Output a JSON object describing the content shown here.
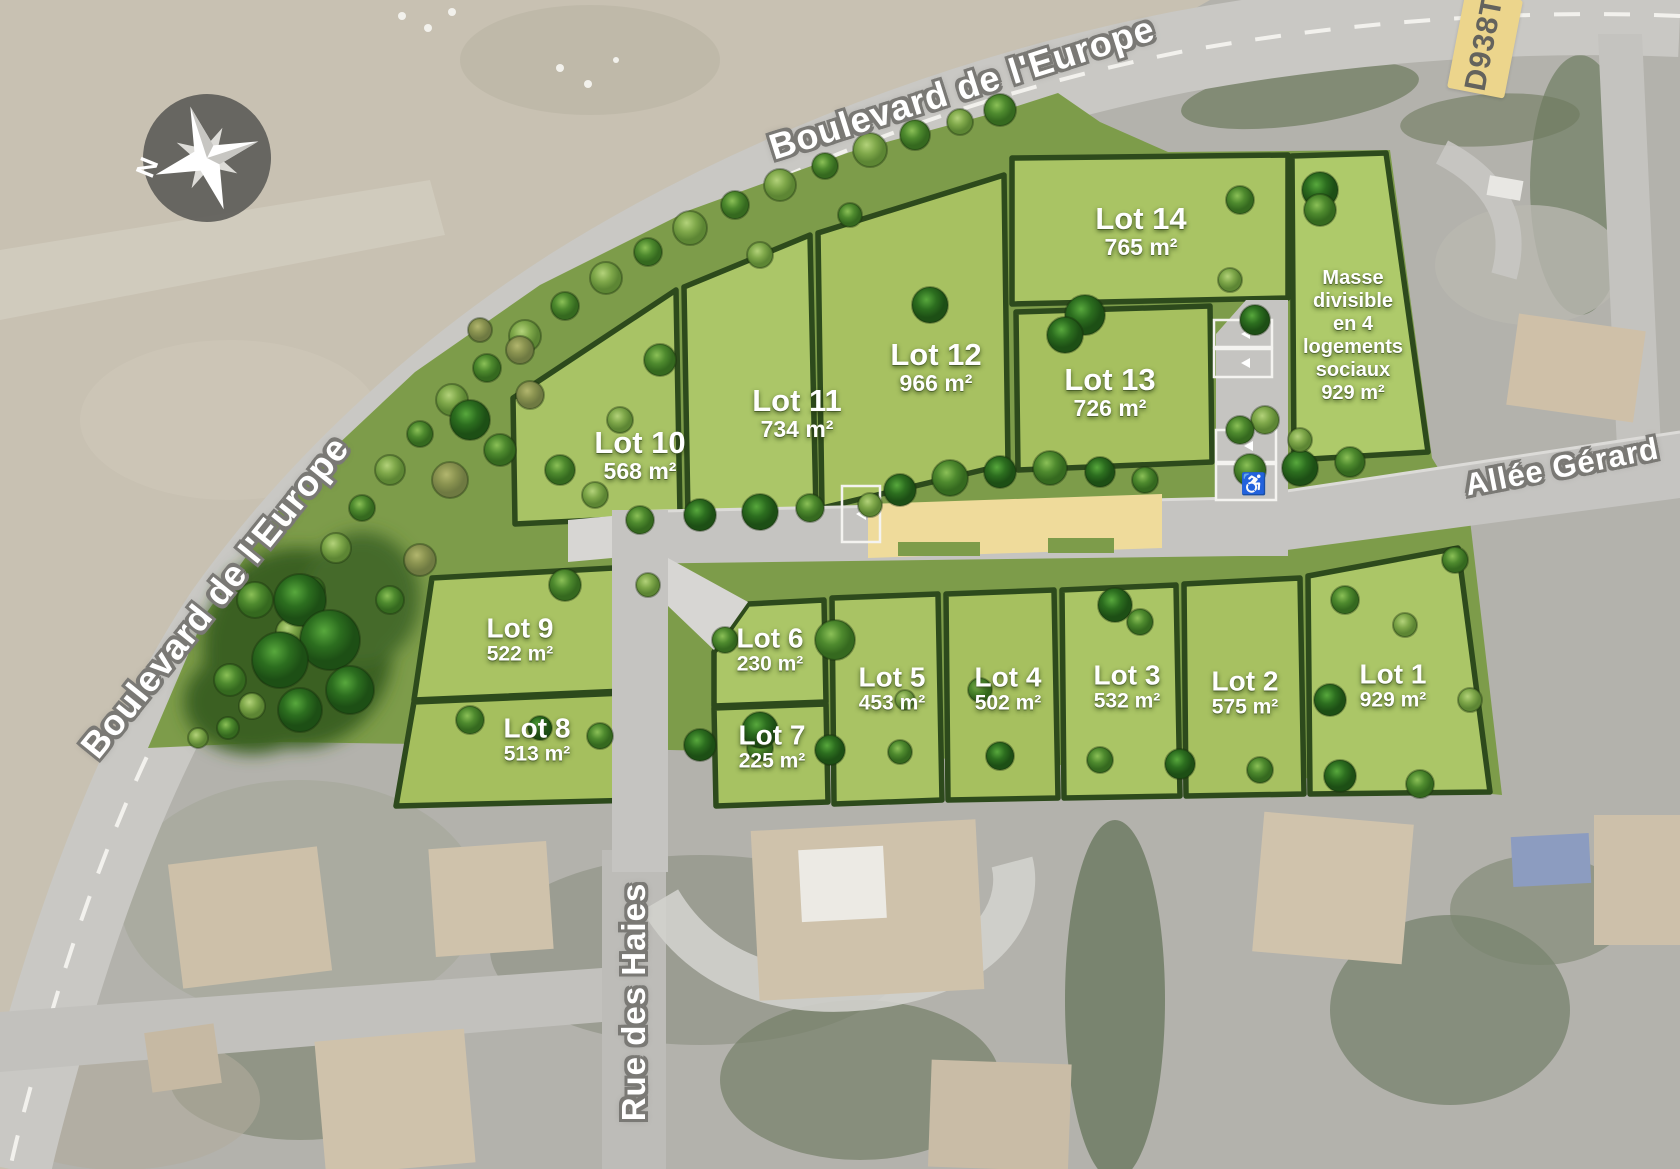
{
  "map": {
    "compass_label": "N",
    "roads": {
      "boulevard_top": "Boulevard de l'Europe",
      "boulevard_left": "Boulevard de l'Europe",
      "rue_des_haies": "Rue des Haies",
      "allee_gerard": "Allée Gérard",
      "d_road_badge": "D938T"
    },
    "lots": [
      {
        "name": "Lot 1",
        "area": "929 m²"
      },
      {
        "name": "Lot 2",
        "area": "575 m²"
      },
      {
        "name": "Lot 3",
        "area": "532 m²"
      },
      {
        "name": "Lot 4",
        "area": "502 m²"
      },
      {
        "name": "Lot 5",
        "area": "453 m²"
      },
      {
        "name": "Lot 6",
        "area": "230 m²"
      },
      {
        "name": "Lot 7",
        "area": "225 m²"
      },
      {
        "name": "Lot 8",
        "area": "513 m²"
      },
      {
        "name": "Lot 9",
        "area": "522 m²"
      },
      {
        "name": "Lot 10",
        "area": "568 m²"
      },
      {
        "name": "Lot 11",
        "area": "734 m²"
      },
      {
        "name": "Lot 12",
        "area": "966 m²"
      },
      {
        "name": "Lot 13",
        "area": "726 m²"
      },
      {
        "name": "Lot 14",
        "area": "765 m²"
      }
    ],
    "special_parcel": {
      "lines": [
        "Masse",
        "divisible",
        "en 4",
        "logements",
        "sociaux",
        "929 m²"
      ]
    },
    "colors": {
      "lot_green": "#a9c363",
      "hedge_dark": "#2d4a1c",
      "band_green": "#7d9c4a",
      "road_gray": "#c5c4c1",
      "speed_table_yellow": "#efdb9b",
      "badge_yellow": "#ecd58c"
    }
  }
}
